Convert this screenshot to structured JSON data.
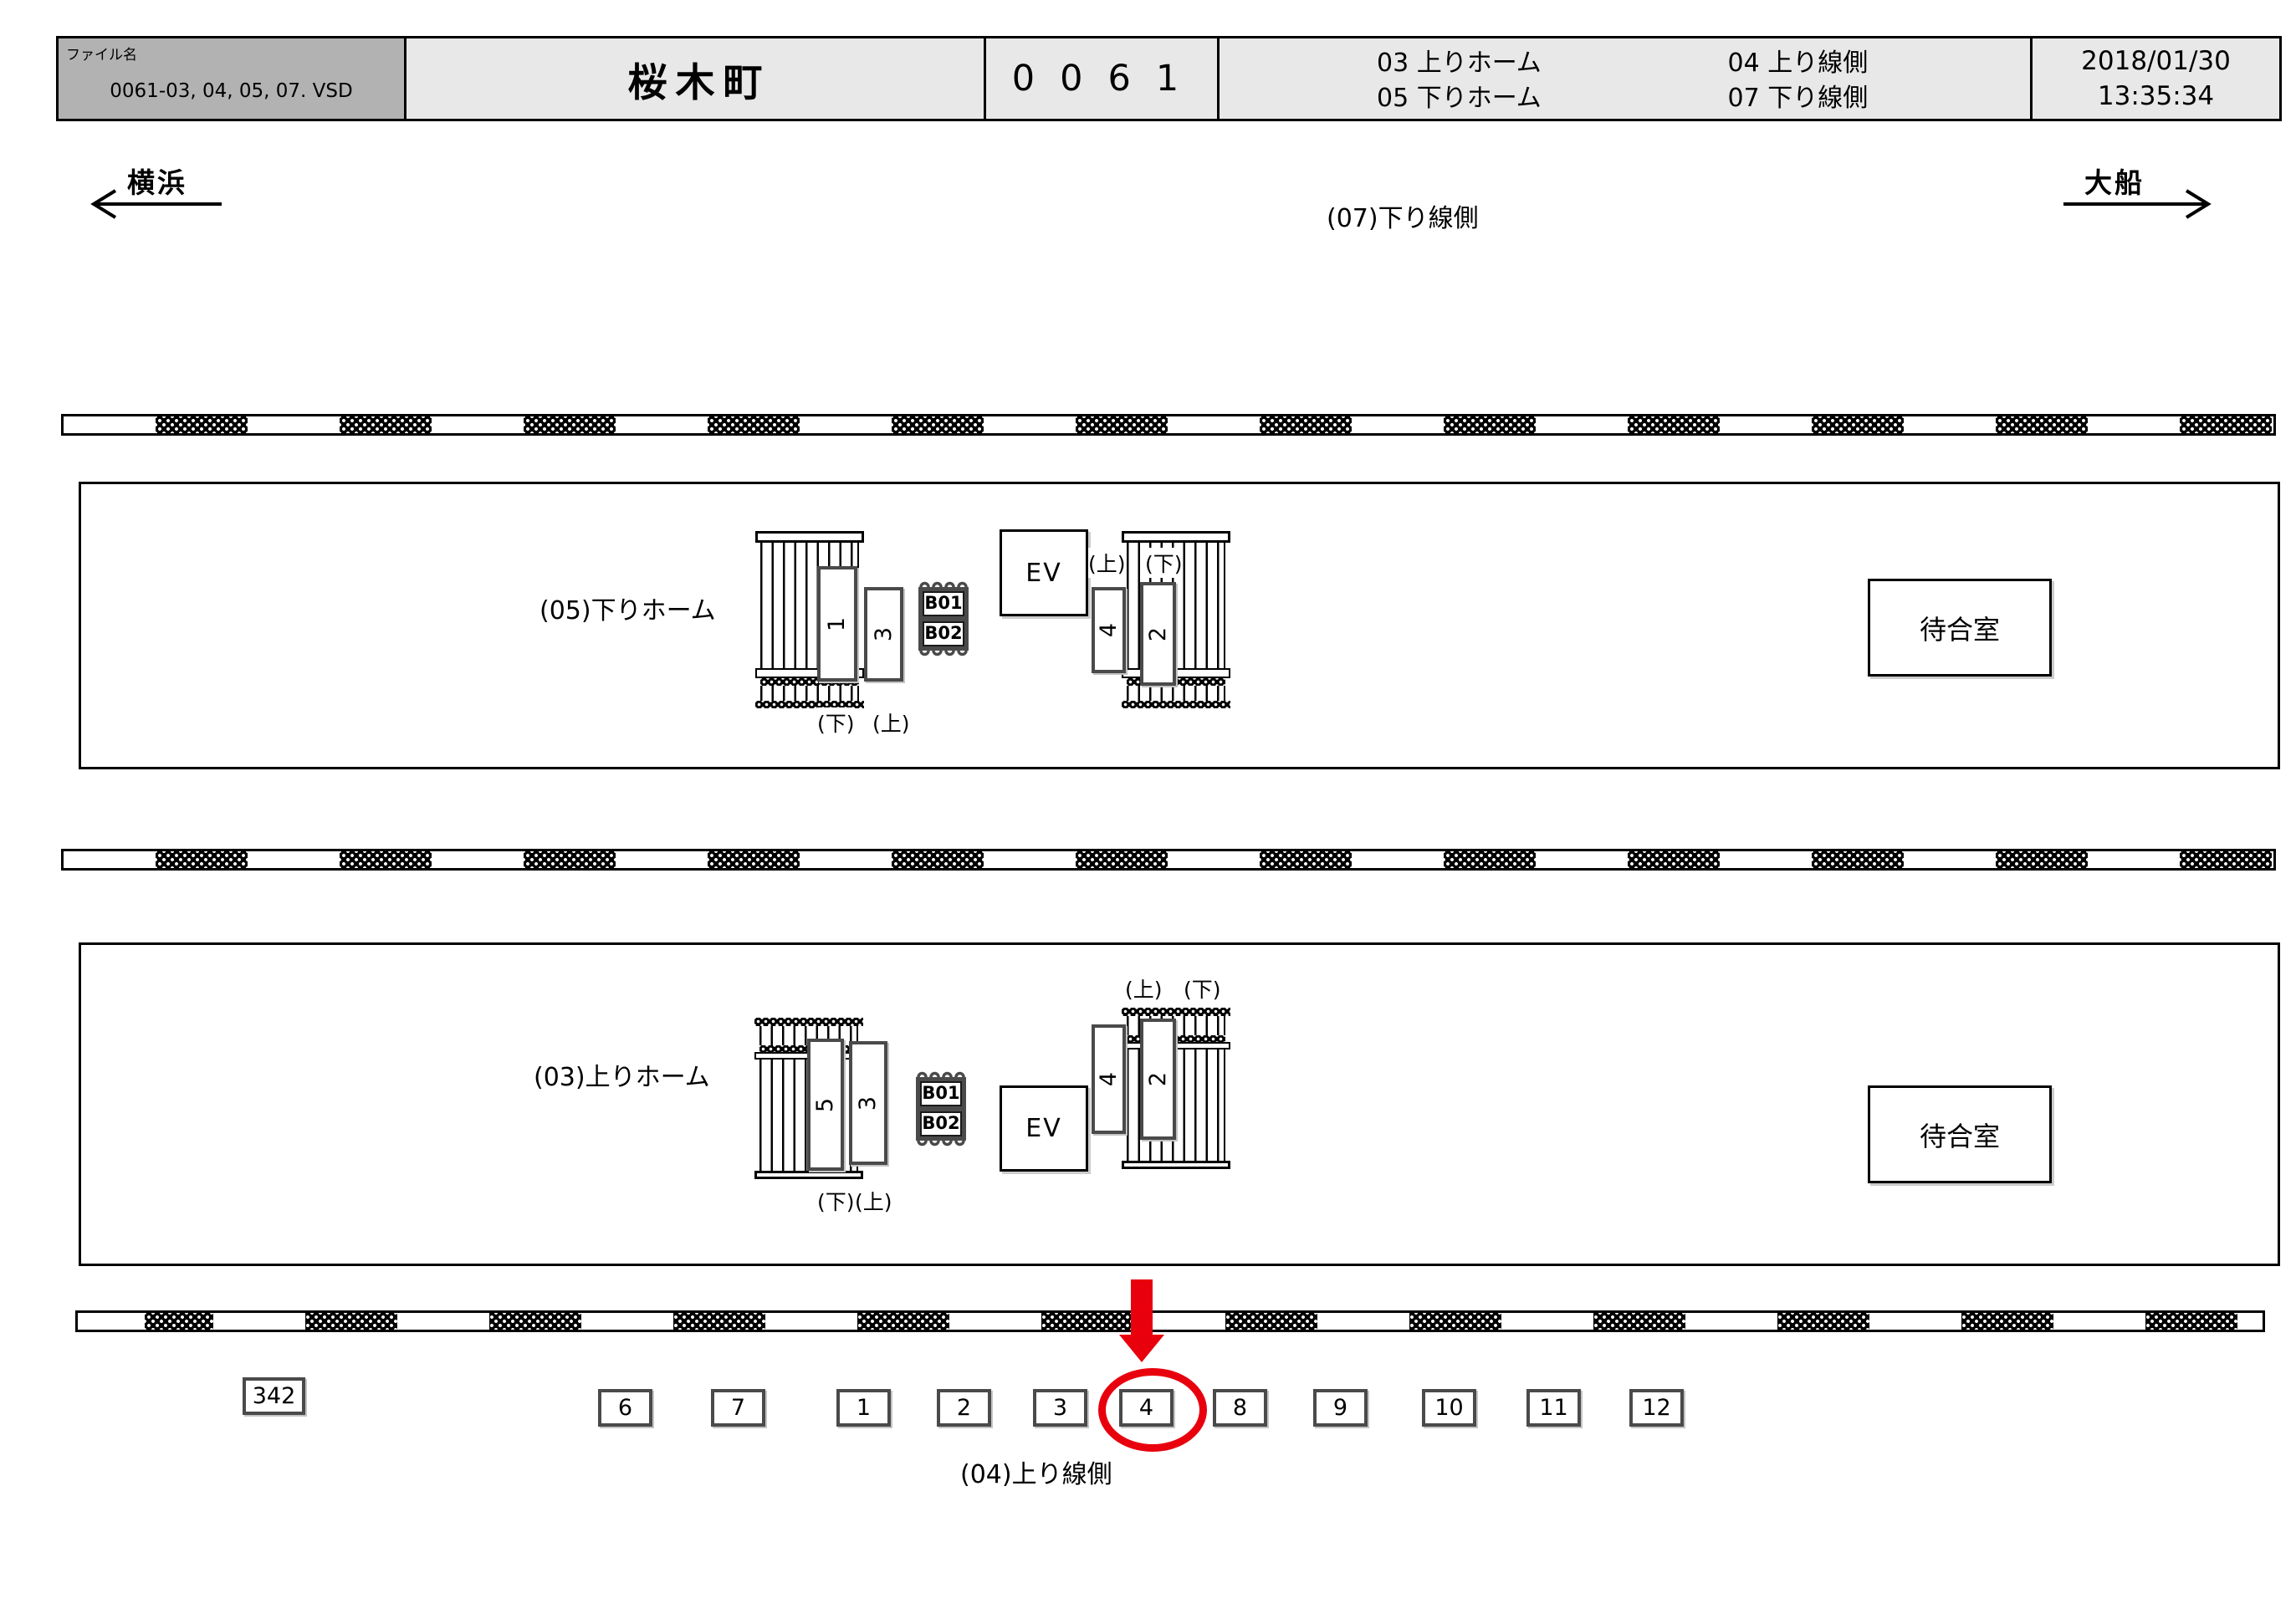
{
  "header": {
    "file_label": "ファイル名",
    "file_name": "0061-03, 04, 05, 07. VSD",
    "station_name": "桜木町",
    "station_code": "0061",
    "legend_r1c1": "03 上りホーム",
    "legend_r1c2": "04 上り線側",
    "legend_r2c1": "05 下りホーム",
    "legend_r2c2": "07 下り線側",
    "date": "2018/01/30",
    "time": "13:35:34"
  },
  "directions": {
    "left": "横浜",
    "right": "大船"
  },
  "labels": {
    "top_area": "(07)下り線側",
    "bottom_area": "(04)上り線側"
  },
  "platforms": [
    {
      "label": "(05)下りホーム",
      "plates": [
        "1",
        "3",
        "4",
        "2"
      ],
      "esc_top": [
        "(上)",
        "(下)"
      ],
      "esc_bottom": [
        "(下)",
        "(上)"
      ],
      "stamp": [
        "B01",
        "B02"
      ],
      "elevator": "EV",
      "waiting_room": "待合室"
    },
    {
      "label": "(03)上りホーム",
      "plates": [
        "5",
        "3",
        "4",
        "2"
      ],
      "esc_top": [
        "(上)",
        "(下)"
      ],
      "esc_bottom": [
        "(下)",
        "(上)"
      ],
      "stamp": [
        "B01",
        "B02"
      ],
      "elevator": "EV",
      "waiting_room": "待合室"
    }
  ],
  "bottom_row": {
    "side_box": "342",
    "boxes": [
      "6",
      "7",
      "1",
      "2",
      "3",
      "4",
      "8",
      "9",
      "10",
      "11",
      "12"
    ],
    "highlighted_box": "4"
  },
  "colors": {
    "highlight_red": "#e8000d",
    "header_gray": "#b2b2b2",
    "header_light": "#e8e8e8"
  }
}
